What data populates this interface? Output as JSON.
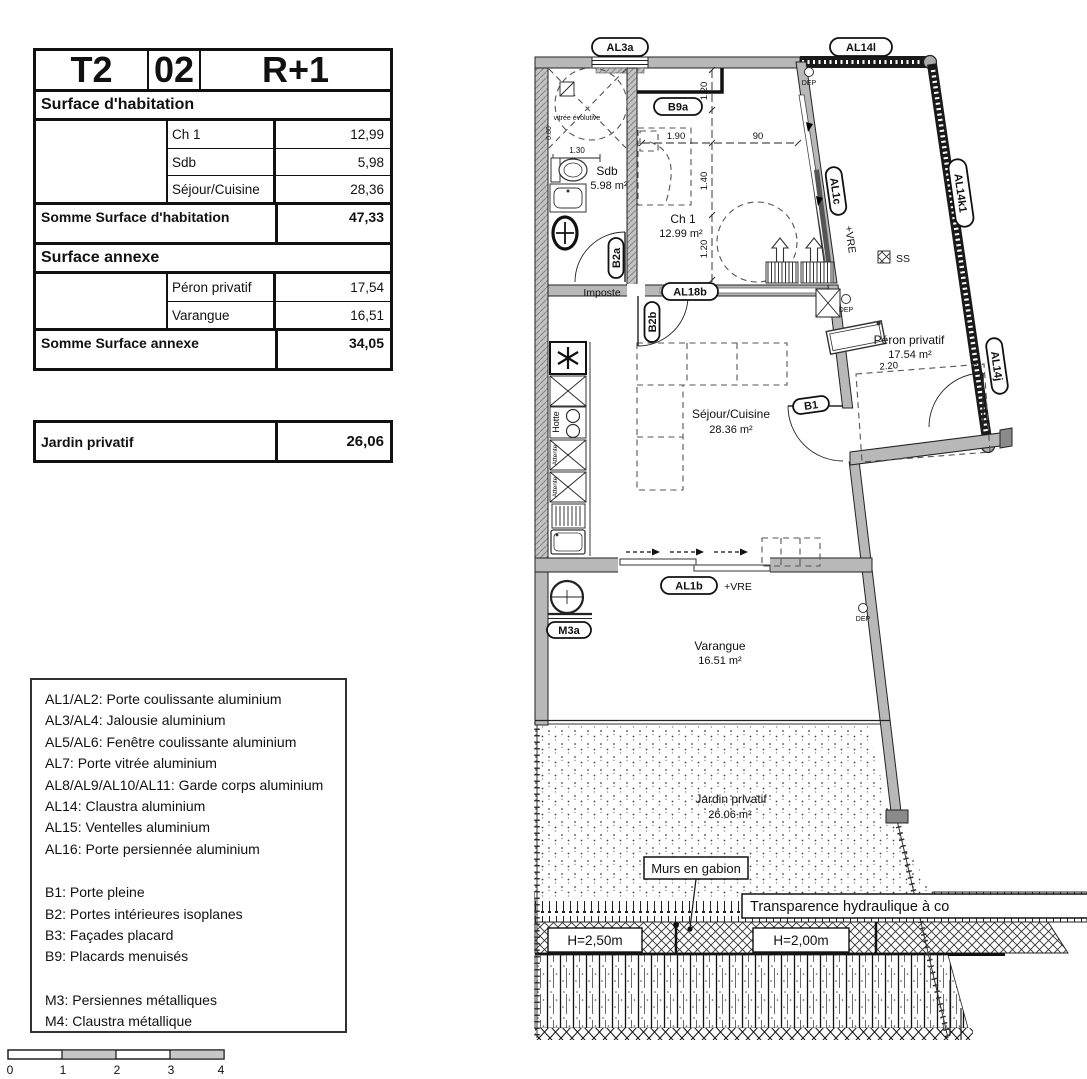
{
  "colors": {
    "wall_gray": "#b8b8b8",
    "ink": "#111111"
  },
  "info_table": {
    "type_label": "T2",
    "unit_number": "02",
    "floor_label": "R+1",
    "habitation": {
      "section_title": "Surface d'habitation",
      "rows": [
        {
          "label": "Ch 1",
          "value": "12,99"
        },
        {
          "label": "Sdb",
          "value": "5,98"
        },
        {
          "label": "Séjour/Cuisine",
          "value": "28,36"
        }
      ],
      "total_label": "Somme Surface d'habitation",
      "total_value": "47,33"
    },
    "annexe": {
      "section_title": "Surface annexe",
      "rows": [
        {
          "label": "Péron privatif",
          "value": "17,54"
        },
        {
          "label": "Varangue",
          "value": "16,51"
        }
      ],
      "total_label": "Somme Surface annexe",
      "total_value": "34,05"
    },
    "jardin": {
      "label": "Jardin privatif",
      "value": "26,06"
    }
  },
  "legend": {
    "items": [
      "AL1/AL2: Porte coulissante aluminium",
      "AL3/AL4: Jalousie aluminium",
      "AL5/AL6: Fenêtre coulissante aluminium",
      "AL7: Porte vitrée aluminium",
      "AL8/AL9/AL10/AL11: Garde corps aluminium",
      "AL14: Claustra aluminium",
      "AL15: Ventelles aluminium",
      "AL16: Porte persiennée aluminium",
      "B1: Porte pleine",
      "B2: Portes intérieures isoplanes",
      "B3: Façades placard",
      "B9: Placards menuisés",
      "M3: Persiennes métalliques",
      "M4: Claustra métallique"
    ]
  },
  "plan": {
    "rooms": {
      "sdb": {
        "name": "Sdb",
        "area": "5.98 m²"
      },
      "ch1": {
        "name": "Ch 1",
        "area": "12.99 m²"
      },
      "sejour": {
        "name": "Séjour/Cuisine",
        "area": "28.36 m²"
      },
      "peron": {
        "name": "Péron privatif",
        "area": "17.54 m²"
      },
      "varangue": {
        "name": "Varangue",
        "area": "16.51 m²"
      },
      "jardin": {
        "name": "Jardin privatif",
        "area": "26.06 m²"
      }
    },
    "tags": {
      "al3a": "AL3a",
      "b9a": "B9a",
      "al14l": "AL14l",
      "al14k1": "AL14k1",
      "al14j": "AL14j",
      "al1c": "AL1c",
      "b2a": "B2a",
      "b2b": "B2b",
      "al18b": "AL18b",
      "b1": "B1",
      "al1b": "AL1b",
      "m3a": "M3a"
    },
    "misc": {
      "dep": "DEP",
      "ss": "SS",
      "imposte": "Imposte",
      "vre": "+VRE",
      "hotte": "Hotte",
      "attente": "Attente",
      "vitree": "vitrée évolutive",
      "gabion": "Murs en gabion",
      "transparence": "Transparence hydraulique à co",
      "h250": "H=2,50m",
      "h200": "H=2,00m"
    },
    "dims": {
      "shower_w": "1.30",
      "shower_d": "0.80",
      "bed_w": "1.90",
      "pass": "90",
      "v_top": "1.20",
      "v_mid": "1.40",
      "v_bot": "1.20",
      "peron_w": "2.20"
    },
    "scale_bar": {
      "ticks": [
        "0",
        "1",
        "2",
        "3",
        "4"
      ]
    }
  }
}
